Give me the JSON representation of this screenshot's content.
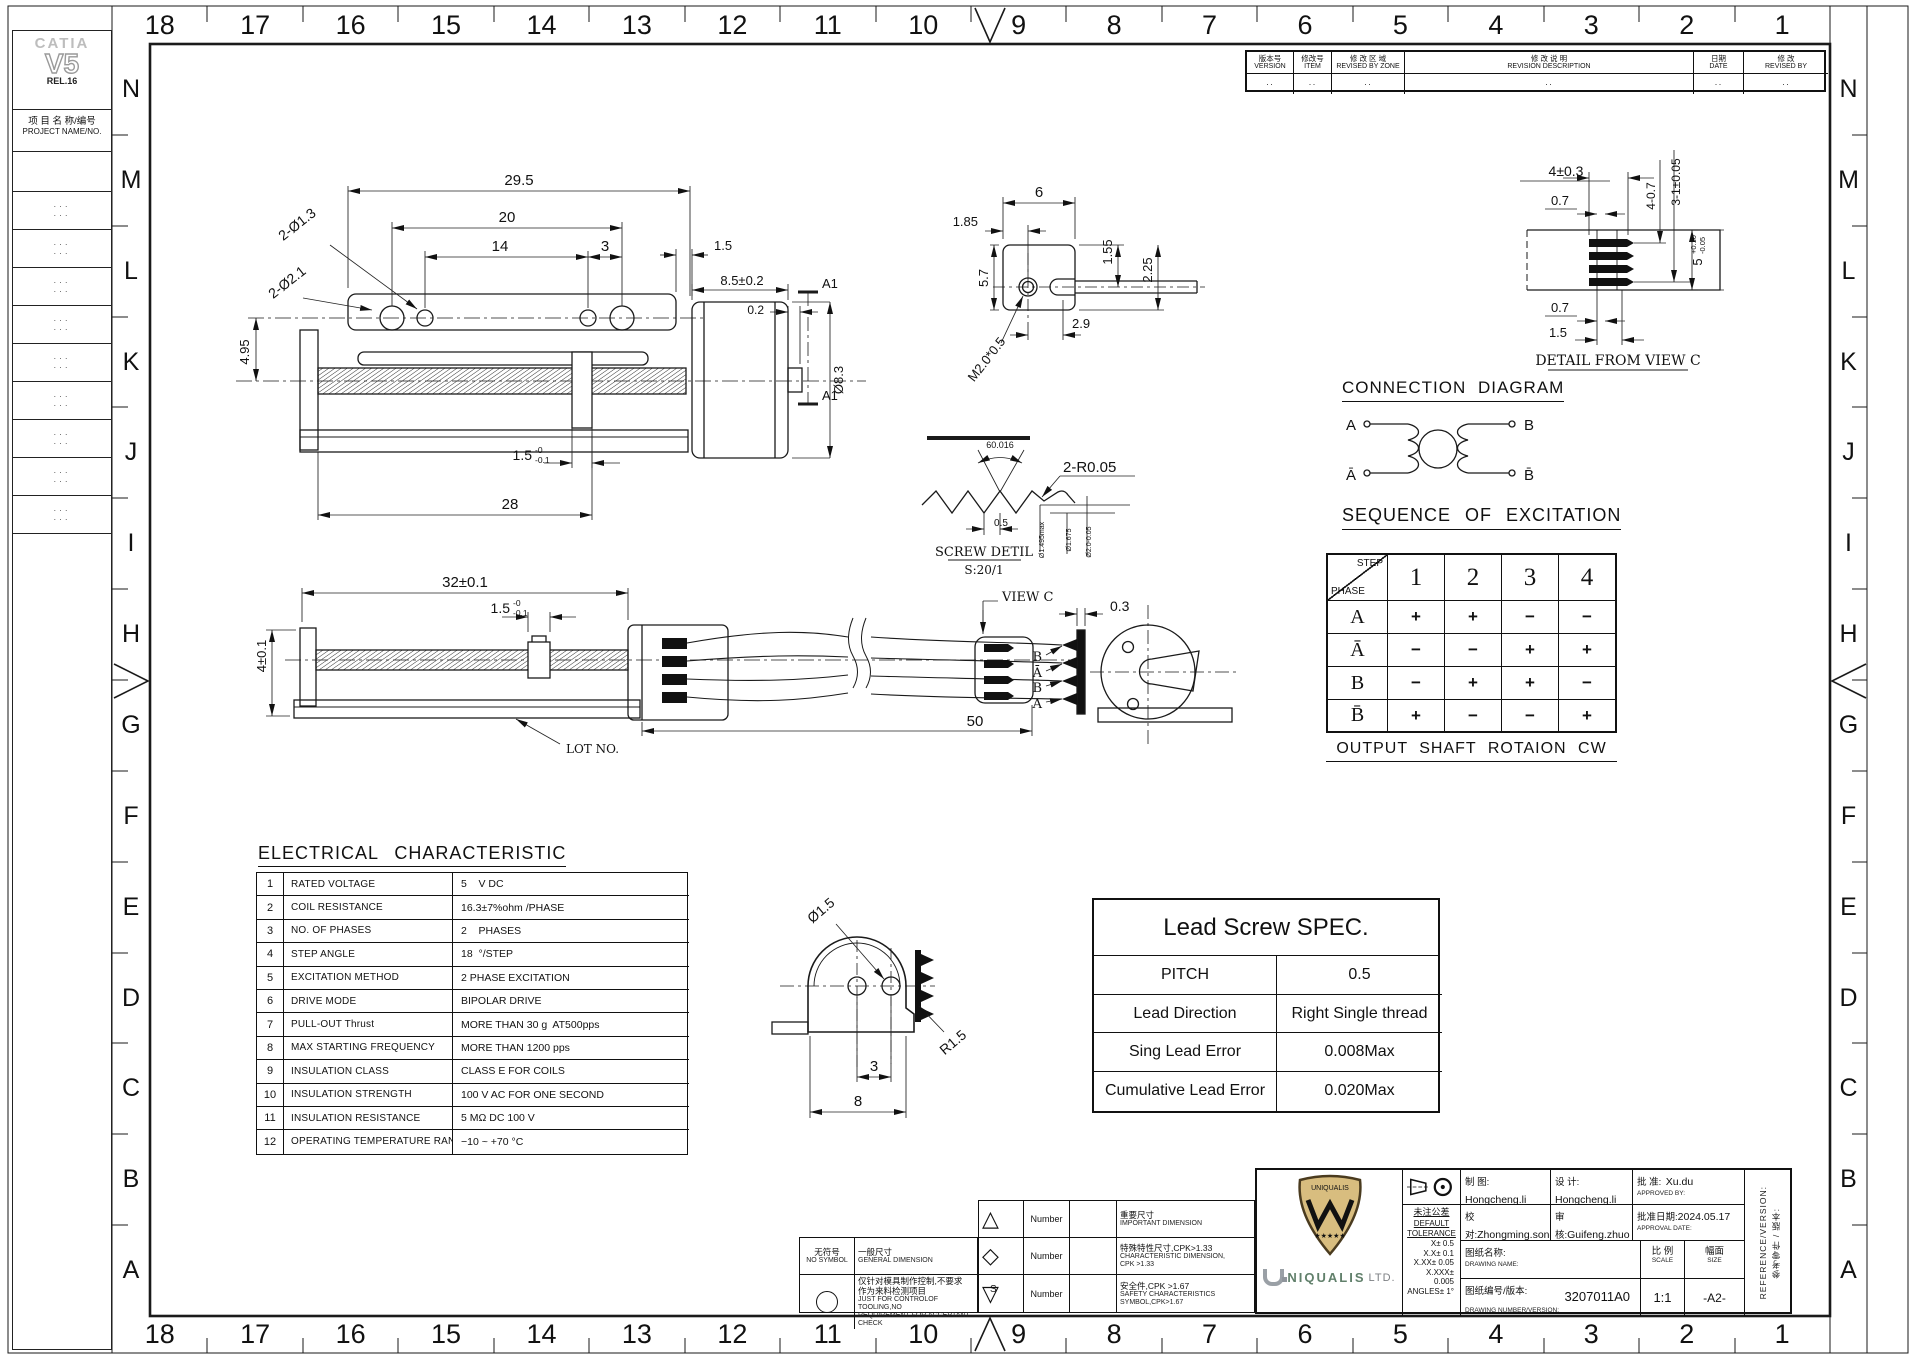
{
  "sheet": {
    "grid_columns": [
      "18",
      "17",
      "16",
      "15",
      "14",
      "13",
      "12",
      "11",
      "10",
      "9",
      "8",
      "7",
      "6",
      "5",
      "4",
      "3",
      "2",
      "1"
    ],
    "grid_rows": [
      "N",
      "M",
      "L",
      "K",
      "J",
      "I",
      "H",
      "G",
      "F",
      "E",
      "D",
      "C",
      "B",
      "A"
    ]
  },
  "sidebar": {
    "cad_brand": "CATIA",
    "cad_version": "V5",
    "cad_release": "REL.16",
    "project_label_cn": "项 目 名 称/编号",
    "project_label_en": "PROJECT NAME/NO.",
    "rows": [
      {
        "a": "···",
        "b": "···"
      },
      {
        "a": "···",
        "b": "···"
      },
      {
        "a": "···",
        "b": "···"
      },
      {
        "a": "···",
        "b": "···"
      },
      {
        "a": "···",
        "b": "···"
      },
      {
        "a": "···",
        "b": "···"
      },
      {
        "a": "···",
        "b": "···"
      },
      {
        "a": "···",
        "b": "···"
      },
      {
        "a": "···",
        "b": "···"
      }
    ]
  },
  "revision_table": {
    "headers": [
      {
        "cn": "版本号",
        "en": "VERSION"
      },
      {
        "cn": "修改号",
        "en": "ITEM"
      },
      {
        "cn": "修 改 区 域",
        "en": "REVISED BY ZONE"
      },
      {
        "cn": "修 改 说 明",
        "en": "REVISION DESCRIPTION"
      },
      {
        "cn": "日期",
        "en": "DATE"
      },
      {
        "cn": "修    改",
        "en": "REVISED BY"
      }
    ],
    "row": [
      "··",
      "··",
      "··",
      "··",
      "··",
      "··"
    ]
  },
  "dims": {
    "top": {
      "total": "29.5",
      "l20": "20",
      "l14": "14",
      "l3": "3",
      "l15": "1.5",
      "l85": "8.5±0.2",
      "l02": "0.2",
      "a1a": "A1",
      "a1b": "A1",
      "holes13": "2-Ø1.3",
      "holes21": "2-Ø2.1",
      "h495": "4.95",
      "dia83": "Ø8.3",
      "nut": "1.5",
      "nut_t": "-0",
      "nut_b": "-0.1",
      "l28": "28"
    },
    "end": {
      "w6": "6",
      "o185": "1.85",
      "h57": "5.7",
      "h155": "1.55",
      "h225": "2.25",
      "w29": "2.9",
      "thread": "M2.0*0.5"
    },
    "screw": {
      "angle": "60.016",
      "rad": "2-R0.05",
      "pitch": "0.5",
      "d1": "Ø1.495max",
      "d2": "Ø1.675",
      "d3": "Ø2.0-0.05",
      "title": "SCREW DETIL",
      "scale": "S:20/1"
    },
    "detailc": {
      "w4": "4±0.3",
      "t07": "0.7",
      "h47": "4-0.7",
      "h31": "3-1±0.05",
      "h5": "5",
      "h5t": "+0.10",
      "h5b": "-0.05",
      "b07": "0.7",
      "b15": "1.5",
      "title": "DETAIL FROM VIEW C"
    },
    "mid": {
      "l32": "32±0.1",
      "nut": "1.5",
      "nut_t": "-0",
      "nut_b": "-0.1",
      "h4": "4±0.1",
      "lot": "LOT NO.",
      "l50": "50",
      "viewc": "VIEW C",
      "g03": "0.3",
      "w1": "B",
      "w2": "Ā",
      "w3": "B̄",
      "w4": "A"
    },
    "bracket": {
      "dia": "Ø1.5",
      "r": "R1.5",
      "w3": "3",
      "w8": "8"
    }
  },
  "connection": {
    "title": "CONNECTION DIAGRAM",
    "a": "A",
    "b": "B",
    "abar": "Ā",
    "bbar": "B̄"
  },
  "sequence": {
    "title": "SEQUENCE OF EXCITATION",
    "corner_top": "STEP",
    "corner_bot": "PHASE",
    "steps": [
      "1",
      "2",
      "3",
      "4"
    ],
    "rows": [
      {
        "phase": "A",
        "c1": "+",
        "c2": "+",
        "c3": "−",
        "c4": "−"
      },
      {
        "phase": "Ā",
        "c1": "−",
        "c2": "−",
        "c3": "+",
        "c4": "+"
      },
      {
        "phase": "B",
        "c1": "−",
        "c2": "+",
        "c3": "+",
        "c4": "−"
      },
      {
        "phase": "B̄",
        "c1": "+",
        "c2": "−",
        "c3": "−",
        "c4": "+"
      }
    ],
    "footer": "OUTPUT SHAFT ROTAION CW"
  },
  "electrical": {
    "title": "ELECTRICAL CHARACTERISTIC",
    "rows": [
      {
        "no": "1",
        "name": "RATED VOLTAGE",
        "value": "5    V DC"
      },
      {
        "no": "2",
        "name": "COIL RESISTANCE",
        "value": "16.3±7%ohm /PHASE"
      },
      {
        "no": "3",
        "name": "NO. OF PHASES",
        "value": "2    PHASES"
      },
      {
        "no": "4",
        "name": "STEP ANGLE",
        "value": "18  °/STEP"
      },
      {
        "no": "5",
        "name": "EXCITATION METHOD",
        "value": "2 PHASE EXCITATION"
      },
      {
        "no": "6",
        "name": "DRIVE MODE",
        "value": "BIPOLAR DRIVE"
      },
      {
        "no": "7",
        "name": "PULL-OUT Thrust",
        "value": "MORE THAN 30 g  AT500pps"
      },
      {
        "no": "8",
        "name": "MAX STARTING FREQUENCY",
        "value": "MORE THAN 1200 pps"
      },
      {
        "no": "9",
        "name": "INSULATION CLASS",
        "value": "CLASS E FOR COILS"
      },
      {
        "no": "10",
        "name": "INSULATION STRENGTH",
        "value": "100 V AC FOR ONE SECOND"
      },
      {
        "no": "11",
        "name": "INSULATION RESISTANCE",
        "value": "5 MΩ DC 100 V"
      },
      {
        "no": "12",
        "name": "OPERATING TEMPERATURE RANGE",
        "value": "−10 ~ +70 °C"
      }
    ]
  },
  "lead_screw": {
    "title": "Lead Screw SPEC.",
    "rows": [
      {
        "name": "PITCH",
        "value": "0.5"
      },
      {
        "name": "Lead Direction",
        "value": "Right Single thread"
      },
      {
        "name": "Sing Lead Error",
        "value": "0.008Max"
      },
      {
        "name": "Cumulative Lead Error",
        "value": "0.020Max"
      }
    ]
  },
  "legend": {
    "no_symbol_cn": "无符号",
    "no_symbol_en": "NO SYMBOL",
    "general_cn": "一般尺寸",
    "general_en": "GENERAL DIMENSION",
    "tooling_cn": "仅针对模具制作控制,不要求\n作为来料检测项目",
    "tooling_en": "JUST FOR CONTROLOF TOOLING,NO\nREQUIREMENT FOR ACCEPTANT CHECK",
    "number_label": "Number",
    "important_cn": "重要尺寸",
    "important_en": "IMPORTANT DIMENSION",
    "characteristic_cn": "特殊特性尺寸,CPK>1.33",
    "characteristic_en": "CHARACTERISTIC DIMENSION,\nCPK >1.33",
    "safety_cn": "安全件,CPK >1.67",
    "safety_en": "SAFETY CHARACTERISTICS\nSYMBOL,CPK>1.67",
    "safety_sym": "S"
  },
  "title_block": {
    "logo_banner": "UNIQUALIS",
    "company_name": "NIQUALIS",
    "company_su": "LTD.",
    "drawn_cn": "制    图:",
    "drawn_en": "DRAWN BY:",
    "drawn_val": "Hongcheng.li",
    "designed_cn": "设    计:",
    "designed_en": "DESIGNED BY:",
    "designed_val": "Hongcheng.li",
    "approved_cn": "批    准:",
    "approved_en": "APPROVED BY:",
    "approved_val": "Xu.du",
    "collated_cn": "校    对:",
    "collated_en": "COLLATED BY:",
    "collated_val": "Zhongming.song",
    "checked_cn": "审    核:",
    "checked_en": "CHECKED BY:",
    "checked_val": "Guifeng.zhuo",
    "date_cn": "批准日期:",
    "date_en": "APPROVAL DATE:",
    "date_val": "2024.05.17",
    "name_cn": "图纸名称:",
    "name_en": "DRAWING NAME:",
    "name_val": "",
    "num_cn": "图纸编号/版本:",
    "num_en": "DRAWING NUMBER/VERSION:",
    "num_val": "3207011A0",
    "scale_cn": "比 例",
    "scale_en": "SCALE",
    "scale_val": "1:1",
    "size_cn": "幅面",
    "size_en": "SIZE",
    "size_val": "-A2-",
    "tol_cn": "未注公差",
    "tol_en1": "DEFAULT",
    "tol_en2": "TOLERANCE",
    "tol_items": [
      "X± 0.5",
      "X.X± 0.1",
      "X.XX± 0.05",
      "X.XXX± 0.005",
      "ANGLES± 1°"
    ],
    "side_cn": "参考零件 / 版本:",
    "side_en": "REFERENCE/VERSION:"
  }
}
